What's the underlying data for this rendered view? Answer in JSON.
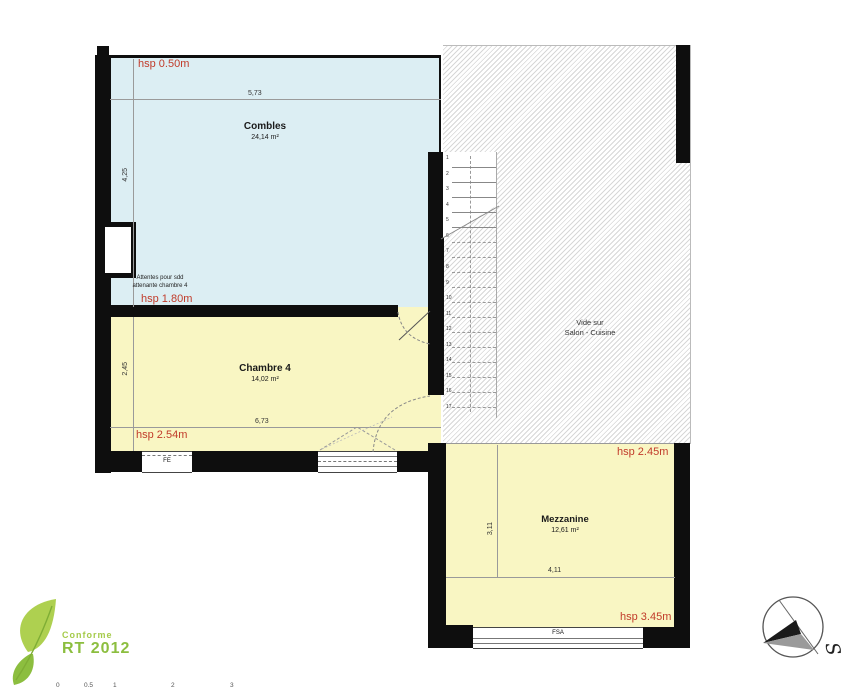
{
  "rooms": {
    "combles": {
      "name": "Combles",
      "area": "24,14 m²"
    },
    "chambre4": {
      "name": "Chambre 4",
      "area": "14,02 m²"
    },
    "mezzanine": {
      "name": "Mezzanine",
      "area": "12,61 m²"
    },
    "vide": {
      "line1": "Vide sur",
      "line2": "Salon - Cuisine"
    }
  },
  "heights": {
    "combles_top": "hsp 0.50m",
    "combles_bottom": "hsp 1.80m",
    "chambre4": "hsp 2.54m",
    "mezzanine_top": "hsp 2.45m",
    "mezzanine_bottom": "hsp 3.45m"
  },
  "dimensions": {
    "combles_width": "5,73",
    "combles_depth": "4,25",
    "chambre4_depth": "2,45",
    "chambre4_width": "6,73",
    "mezzanine_depth": "3,11",
    "mezzanine_width": "4,11"
  },
  "note": {
    "line1": "Attentes pour sdd",
    "line2": "attenante chambre 4"
  },
  "windows": {
    "fe": "FE",
    "fsa": "FSA"
  },
  "stair": {
    "steps_total": 17,
    "steps_solid": 5
  },
  "compass": {
    "letter": "S"
  },
  "badge": {
    "line1": "Conforme",
    "line2": "RT 2012"
  },
  "scale_bar": {
    "ticks": [
      "0",
      "0.5",
      "1",
      "2",
      "3"
    ]
  },
  "colors": {
    "combles_blue": "#dceef3",
    "room_yellow": "#f9f6c3",
    "height_red": "#c13b2a",
    "wall_black": "#0e0e0e",
    "badge_green": "#8cbe3f"
  }
}
